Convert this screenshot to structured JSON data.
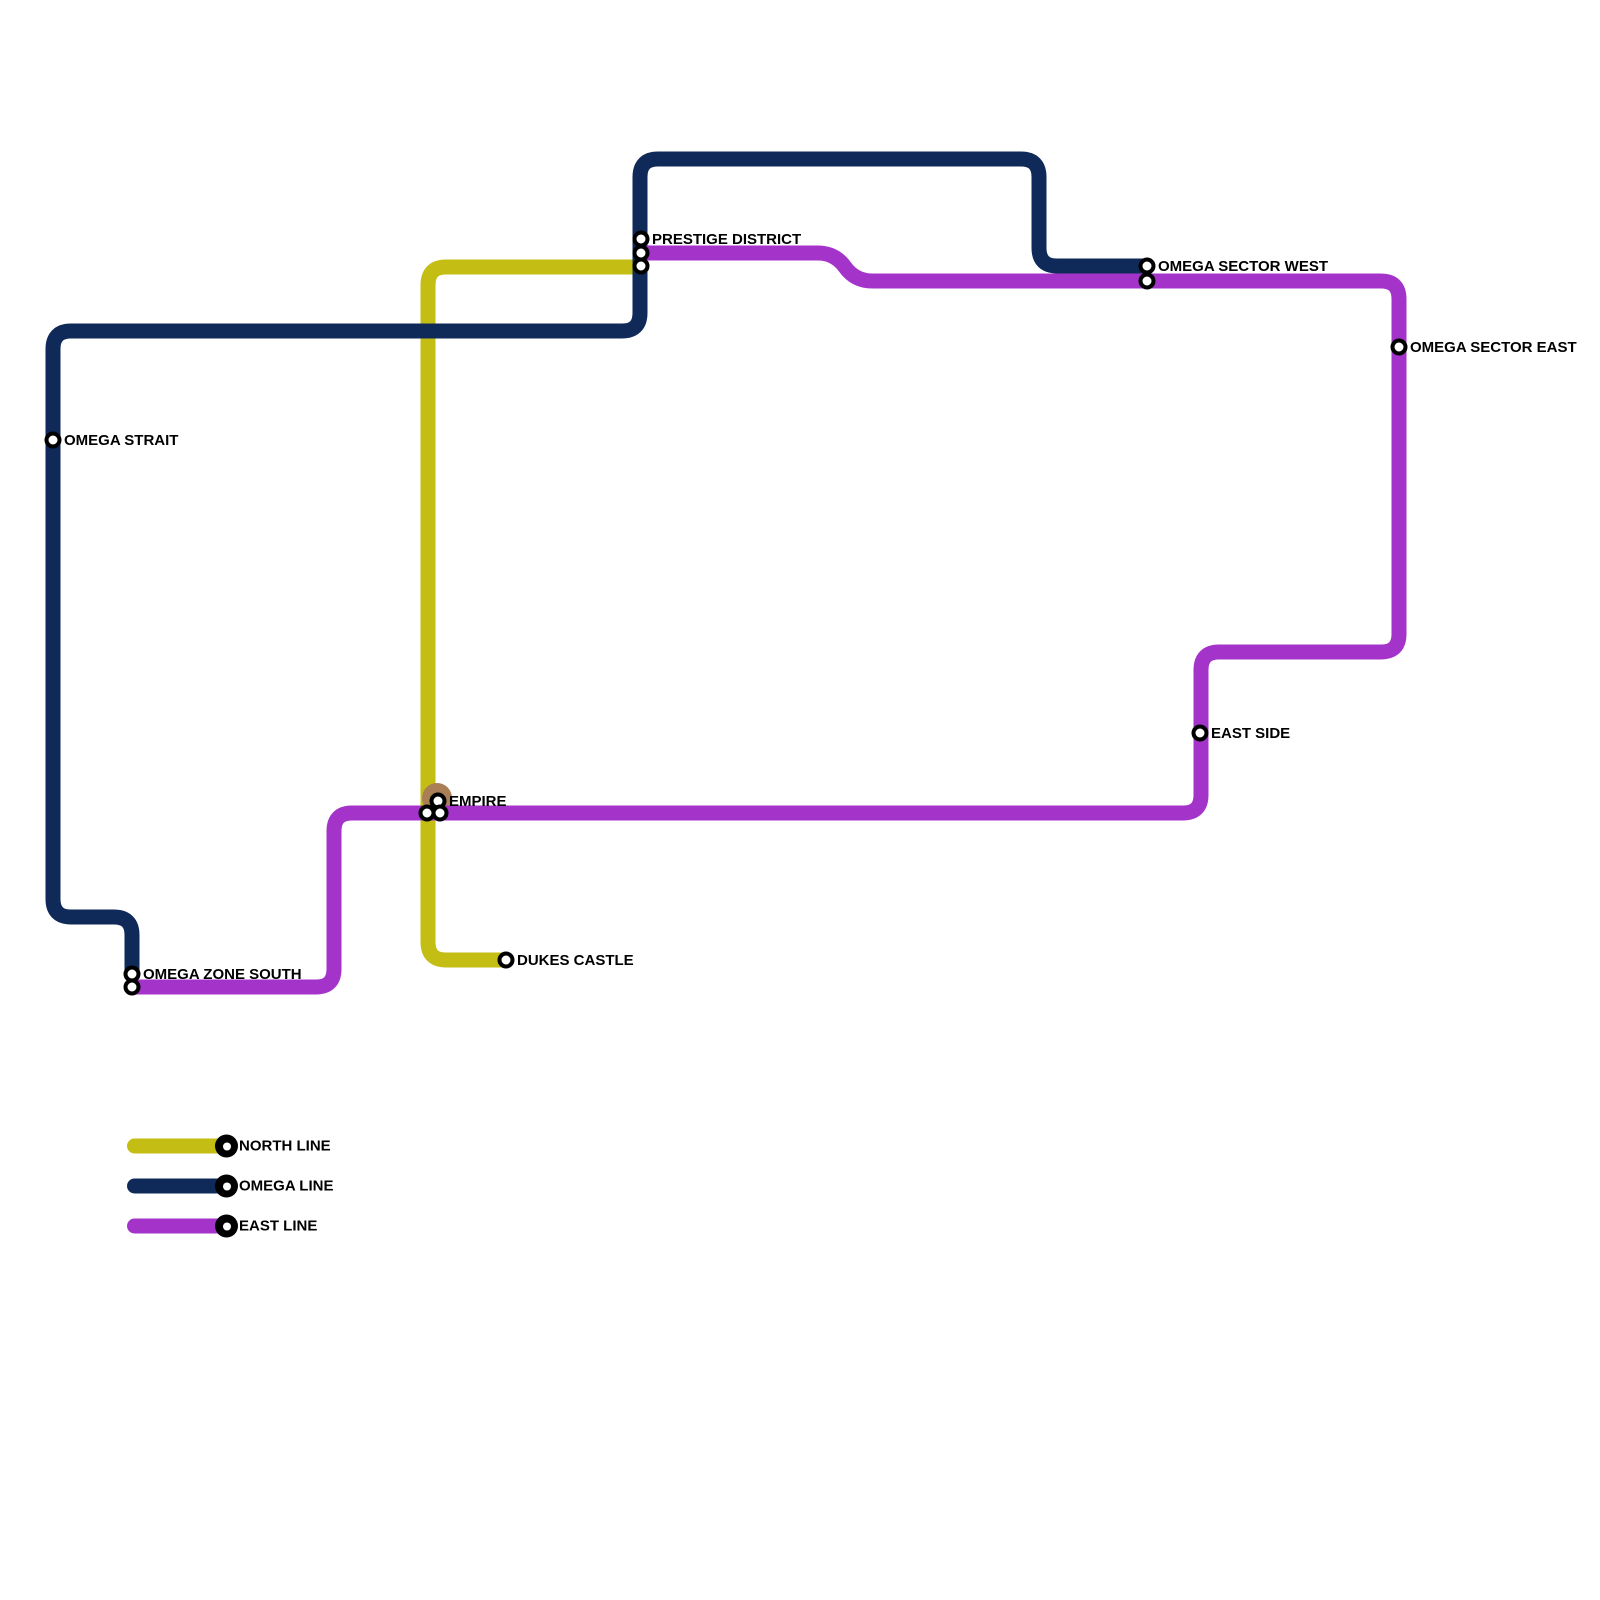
{
  "map": {
    "width": 1600,
    "height": 1600,
    "background": "#ffffff",
    "line_thickness": 15,
    "corner_radius": 18,
    "station_style": {
      "radius": 6.5,
      "fill": "#ffffff",
      "ring": "#000000",
      "ring_width": 4
    },
    "label_style": {
      "color": "#000000",
      "size": 15,
      "dx": 11,
      "dy": 5
    }
  },
  "lines": [
    {
      "id": "north-line",
      "name": "NORTH LINE",
      "color": "#c3bd14",
      "points": [
        [
          641,
          267
        ],
        [
          428,
          267
        ],
        [
          428,
          960
        ],
        [
          506,
          960
        ]
      ]
    },
    {
      "id": "omega-line",
      "name": "OMEGA LINE",
      "color": "#0f2a58",
      "points": [
        [
          1147,
          266
        ],
        [
          1039,
          266
        ],
        [
          1039,
          159
        ],
        [
          640,
          159
        ],
        [
          640,
          331
        ],
        [
          53,
          331
        ],
        [
          53,
          917
        ],
        [
          132,
          917
        ],
        [
          132,
          974
        ]
      ]
    },
    {
      "id": "east-line",
      "name": "EAST LINE",
      "color": "#a434c9",
      "points": [
        [
          641,
          253
        ],
        [
          835,
          253
        ],
        [
          855,
          281
        ],
        [
          1399,
          281
        ],
        [
          1399,
          652
        ],
        [
          1201,
          652
        ],
        [
          1201,
          813
        ],
        [
          334,
          813
        ],
        [
          334,
          987
        ],
        [
          132,
          987
        ]
      ]
    }
  ],
  "highlights": [
    {
      "id": "empire-highlight",
      "x": 437,
      "y": 798,
      "r": 15,
      "color": "#aa7f55",
      "after_line": 1
    }
  ],
  "stations": [
    {
      "name": "PRESTIGE DISTRICT",
      "circles": [
        [
          641,
          239
        ],
        [
          641,
          253
        ],
        [
          641,
          266
        ]
      ]
    },
    {
      "name": "OMEGA SECTOR WEST",
      "circles": [
        [
          1147,
          266
        ],
        [
          1147,
          281
        ]
      ]
    },
    {
      "name": "OMEGA SECTOR EAST",
      "circles": [
        [
          1399,
          347
        ]
      ]
    },
    {
      "name": "OMEGA STRAIT",
      "circles": [
        [
          53,
          440
        ]
      ]
    },
    {
      "name": "EAST SIDE",
      "circles": [
        [
          1200,
          733
        ]
      ]
    },
    {
      "name": "EMPIRE",
      "circles": [
        [
          438,
          801
        ],
        [
          427,
          813
        ],
        [
          440,
          813
        ]
      ]
    },
    {
      "name": "OMEGA ZONE SOUTH",
      "circles": [
        [
          132,
          974
        ],
        [
          132,
          987
        ]
      ]
    },
    {
      "name": "DUKES CASTLE",
      "circles": [
        [
          506,
          960
        ]
      ]
    }
  ],
  "legend": {
    "items": [
      {
        "label": "NORTH LINE",
        "color": "#c3bd14"
      },
      {
        "label": "OMEGA LINE",
        "color": "#0f2a58"
      },
      {
        "label": "EAST LINE",
        "color": "#a434c9"
      }
    ]
  }
}
